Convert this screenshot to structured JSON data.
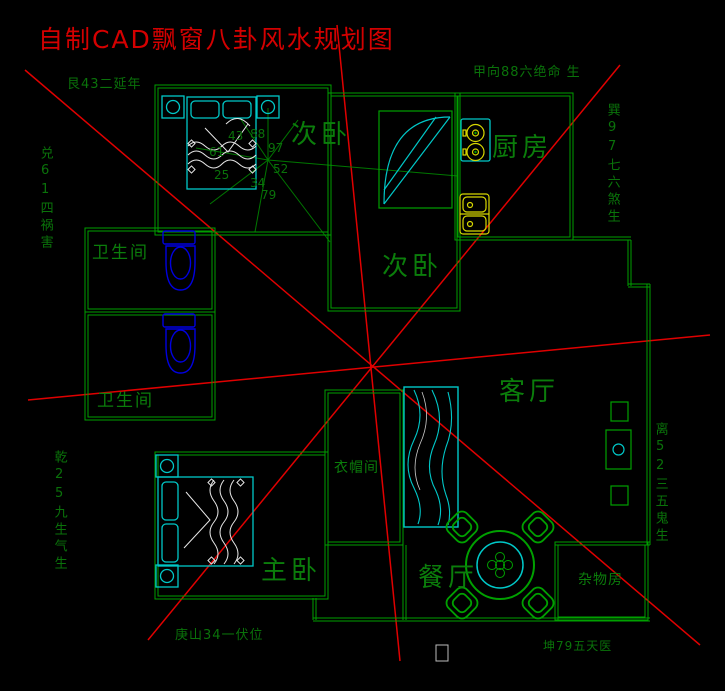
{
  "title": "自制CAD飘窗八卦风水规划图",
  "perimeter_labels": {
    "top_left": "艮43二延年",
    "top": "甲向88六绝命 生",
    "left_upper": "兑61四祸害",
    "right_upper": "巽97七六煞生",
    "right_lower": "离52三五鬼生",
    "left_lower": "乾25九生气生",
    "bottom_left": "庚山34一伏位",
    "bottom_right": "坤79五天医"
  },
  "room_labels": {
    "bedroom2_a": "次卧",
    "bedroom2_b": "次卧",
    "kitchen": "厨房",
    "bathroom_1": "卫生间",
    "bathroom_2": "卫生间",
    "living_room": "客厅",
    "cloakroom": "衣帽间",
    "master_bedroom": "主卧",
    "dining_room": "餐厅",
    "storage_room": "杂物房"
  },
  "bagua_numbers": {
    "n43": "43",
    "n88": "88",
    "n97": "97",
    "n61": "61",
    "n52": "52",
    "n25": "25",
    "n34": "34",
    "n79": "79"
  },
  "colors": {
    "background": "#000000",
    "wall_green": "#00a000",
    "label_green": "#0b7d0b",
    "line_red": "#e00000",
    "furniture_cyan": "#00c8c8",
    "fixture_yellow": "#d8d800",
    "toilet_blue": "#0000e0",
    "detail_white": "#ffffff"
  }
}
